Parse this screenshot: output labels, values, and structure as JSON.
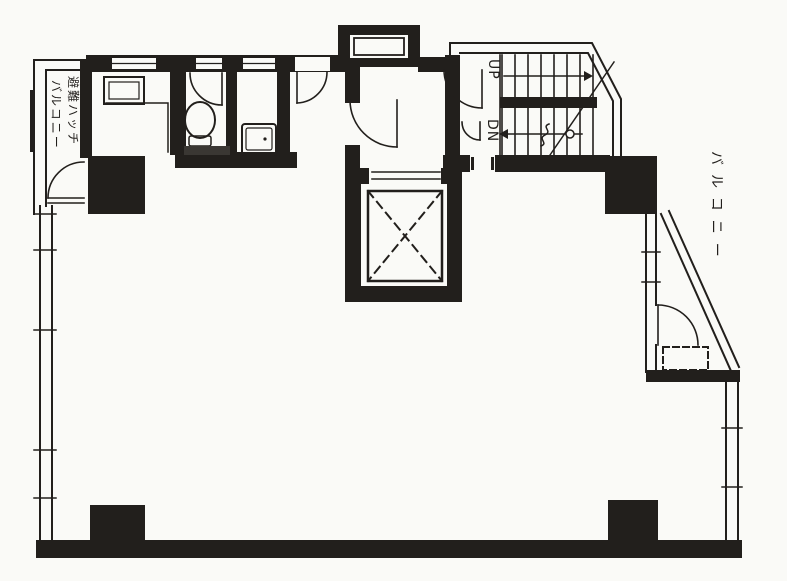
{
  "document": {
    "type": "architectural-floor-plan",
    "style": "scanned black-and-white blueprint"
  },
  "labels": {
    "left_balcony_line1": "避難ハッチ",
    "left_balcony_line2": "バルコニー",
    "right_balcony": "バルコニー",
    "stairs_up": "UP",
    "stairs_down": "DN"
  },
  "features": [
    "balcony-with-escape-hatch (top-left)",
    "utility-alcove-with-counter",
    "toilet-room",
    "sink-room",
    "pipe-duct-shaft (top-center)",
    "elevator-shaft-with-x-symbol",
    "staircase-up-down-with-chamfered-corner",
    "right-balcony-with-diagonal-edge-and-escape-hatch",
    "large-open-main-room",
    "four-black-structural-columns"
  ],
  "colors": {
    "ink": "#221f1c",
    "paper": "#fafaf7",
    "hatch_band": "#3a3733"
  }
}
